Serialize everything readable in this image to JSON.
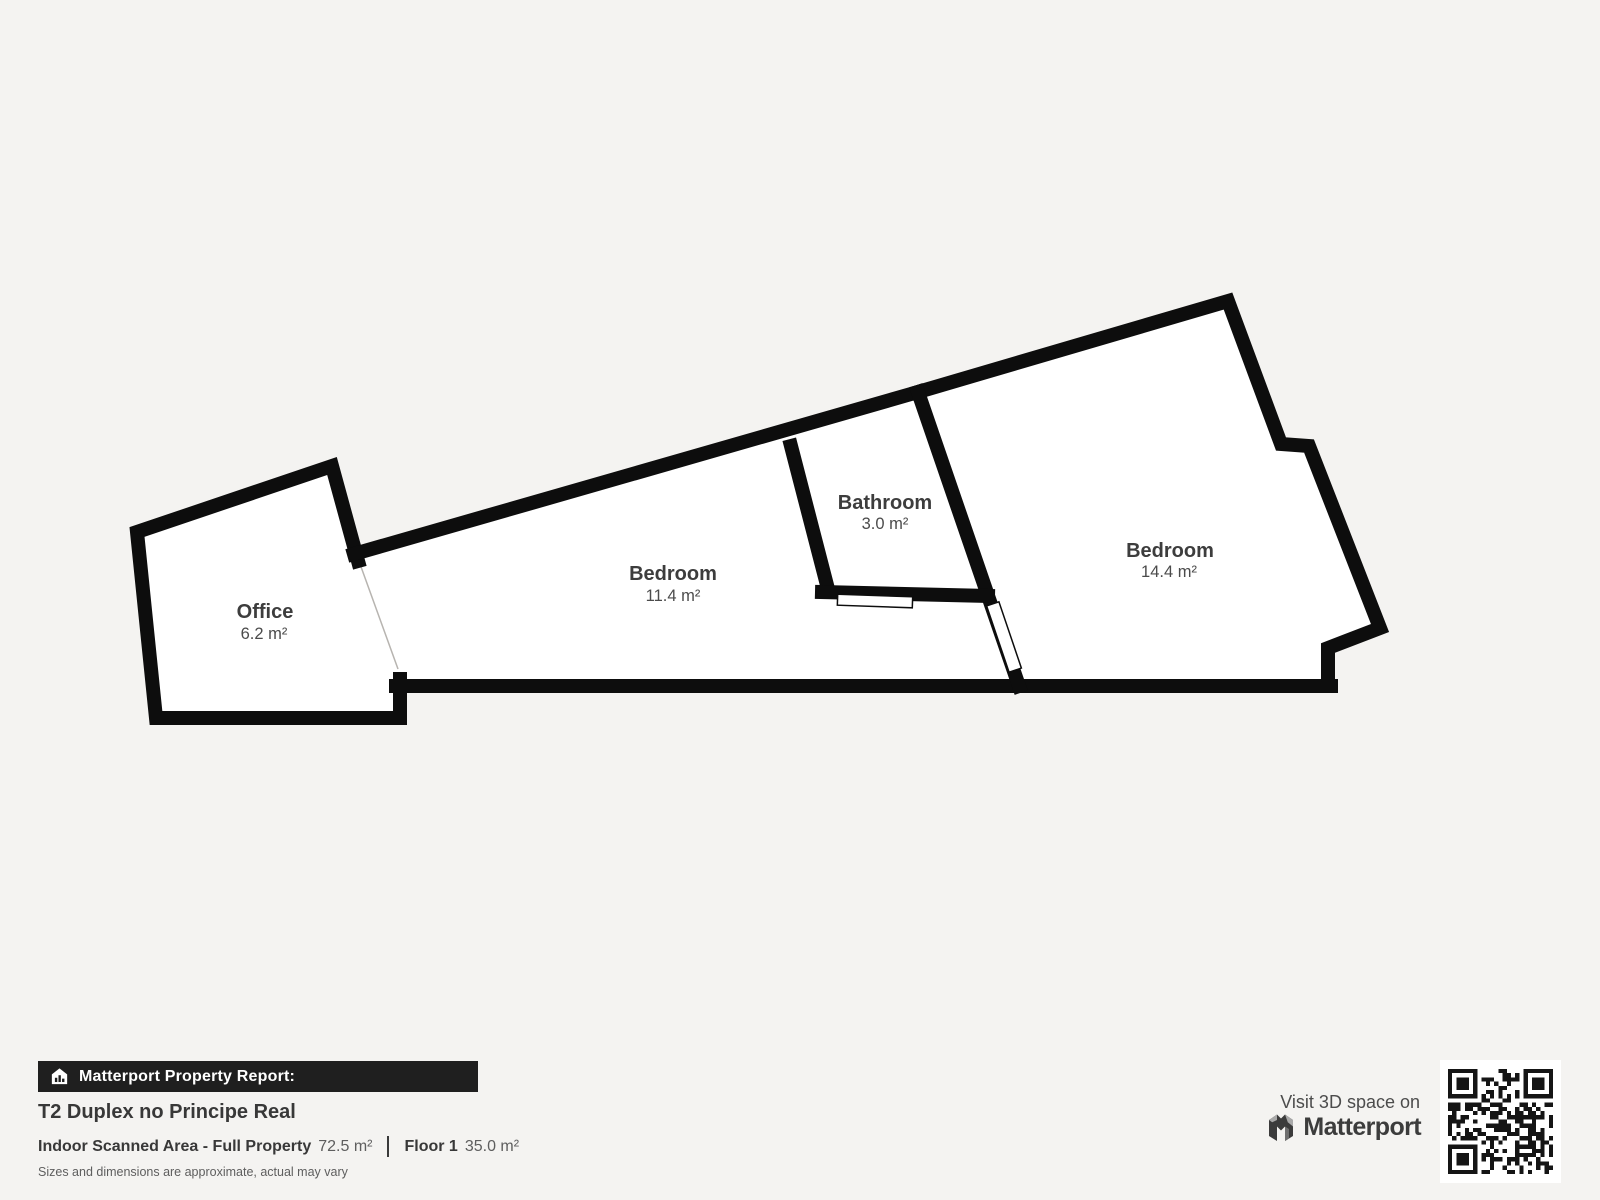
{
  "colors": {
    "background": "#f4f3f1",
    "wall": "#0d0d0d",
    "room_fill": "#ffffff",
    "bar_background": "#1f1f1f",
    "text_dark": "#383838",
    "text_mid": "#5e5e5e"
  },
  "plan": {
    "rooms": [
      {
        "name": "Office",
        "area": "6.2 m²"
      },
      {
        "name": "Bedroom",
        "area": "11.4 m²"
      },
      {
        "name": "Bathroom",
        "area": "3.0 m²"
      },
      {
        "name": "Bedroom",
        "area": "14.4 m²"
      }
    ]
  },
  "report": {
    "bar_label": "Matterport Property Report:",
    "title": "T2 Duplex no Principe Real",
    "scanned_area_label": "Indoor Scanned Area - Full Property",
    "scanned_area_value": "72.5 m²",
    "floor_label": "Floor 1",
    "floor_value": "35.0 m²",
    "disclaimer": "Sizes and dimensions are approximate, actual may vary"
  },
  "promo": {
    "visit_label": "Visit 3D space on",
    "brand": "Matterport"
  }
}
